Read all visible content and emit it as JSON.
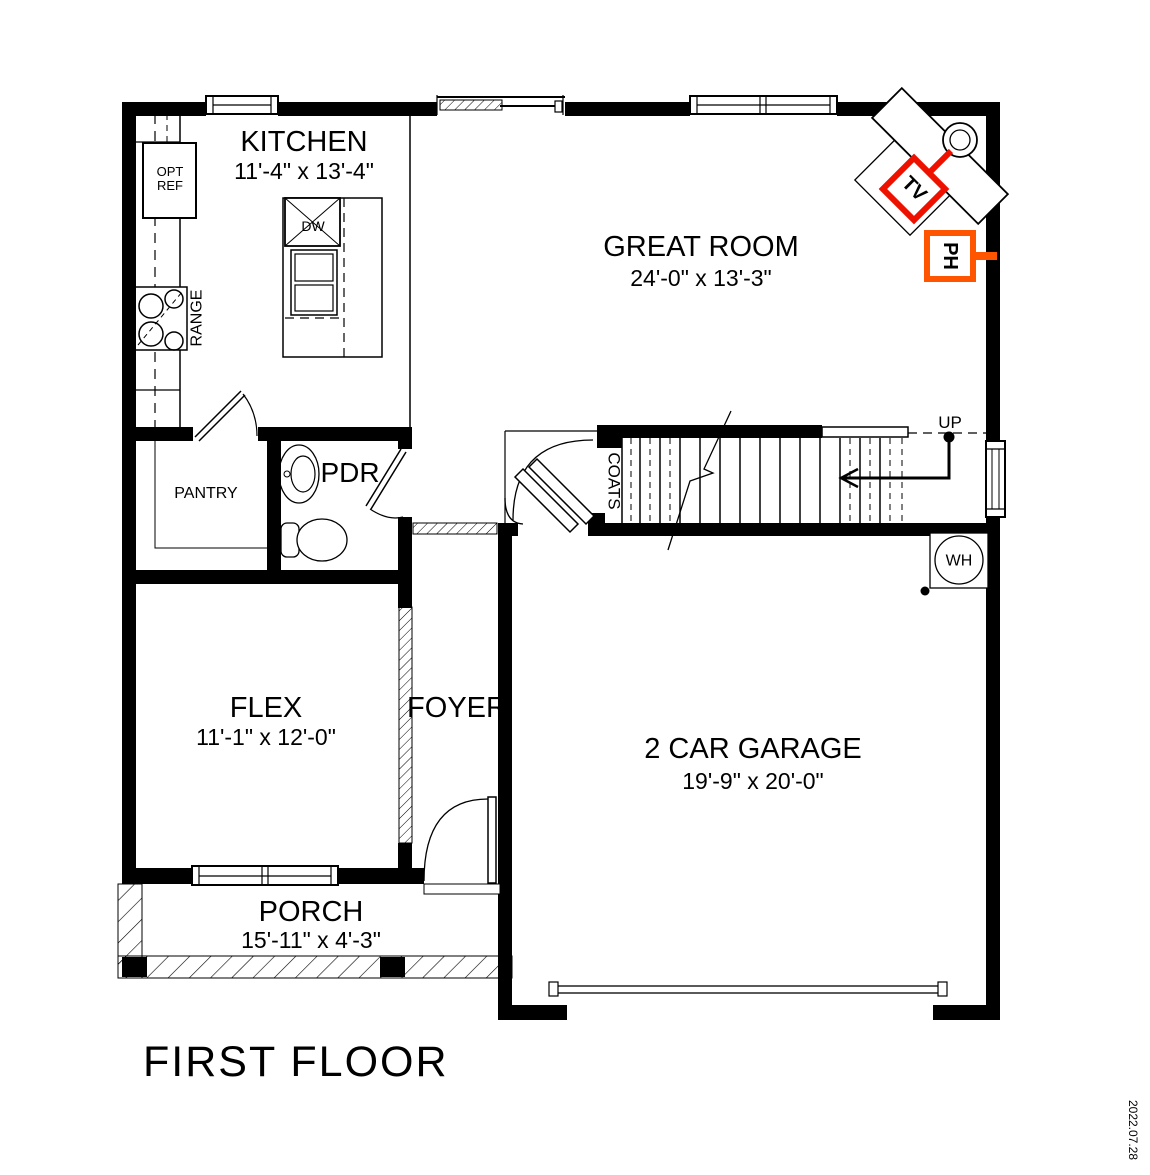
{
  "title": "FIRST FLOOR",
  "revision_date": "2022.07.28",
  "rooms": {
    "kitchen": {
      "name": "KITCHEN",
      "dims": "11'-4\" x 13'-4\""
    },
    "great_room": {
      "name": "GREAT ROOM",
      "dims": "24'-0\" x 13'-3\""
    },
    "flex": {
      "name": "FLEX",
      "dims": "11'-1\" x 12'-0\""
    },
    "foyer": {
      "name": "FOYER"
    },
    "garage": {
      "name": "2 CAR GARAGE",
      "dims": "19'-9\" x 20'-0\""
    },
    "porch": {
      "name": "PORCH",
      "dims": "15'-11\" x 4'-3\""
    },
    "pantry": {
      "name": "PANTRY"
    },
    "powder_room": {
      "name": "PDR"
    },
    "coats_closet": {
      "name": "COATS"
    }
  },
  "annotations": {
    "up": "UP",
    "water_heater": "WH",
    "tv_outlet": "TV",
    "phone_outlet": "PH",
    "dishwasher": "DW",
    "range": "RANGE",
    "opt_ref_line1": "OPT",
    "opt_ref_line2": "REF"
  },
  "colors": {
    "wall": "#000000",
    "tv_marker": "#ee1100",
    "ph_marker": "#ff5400",
    "date_text": "#808080"
  }
}
